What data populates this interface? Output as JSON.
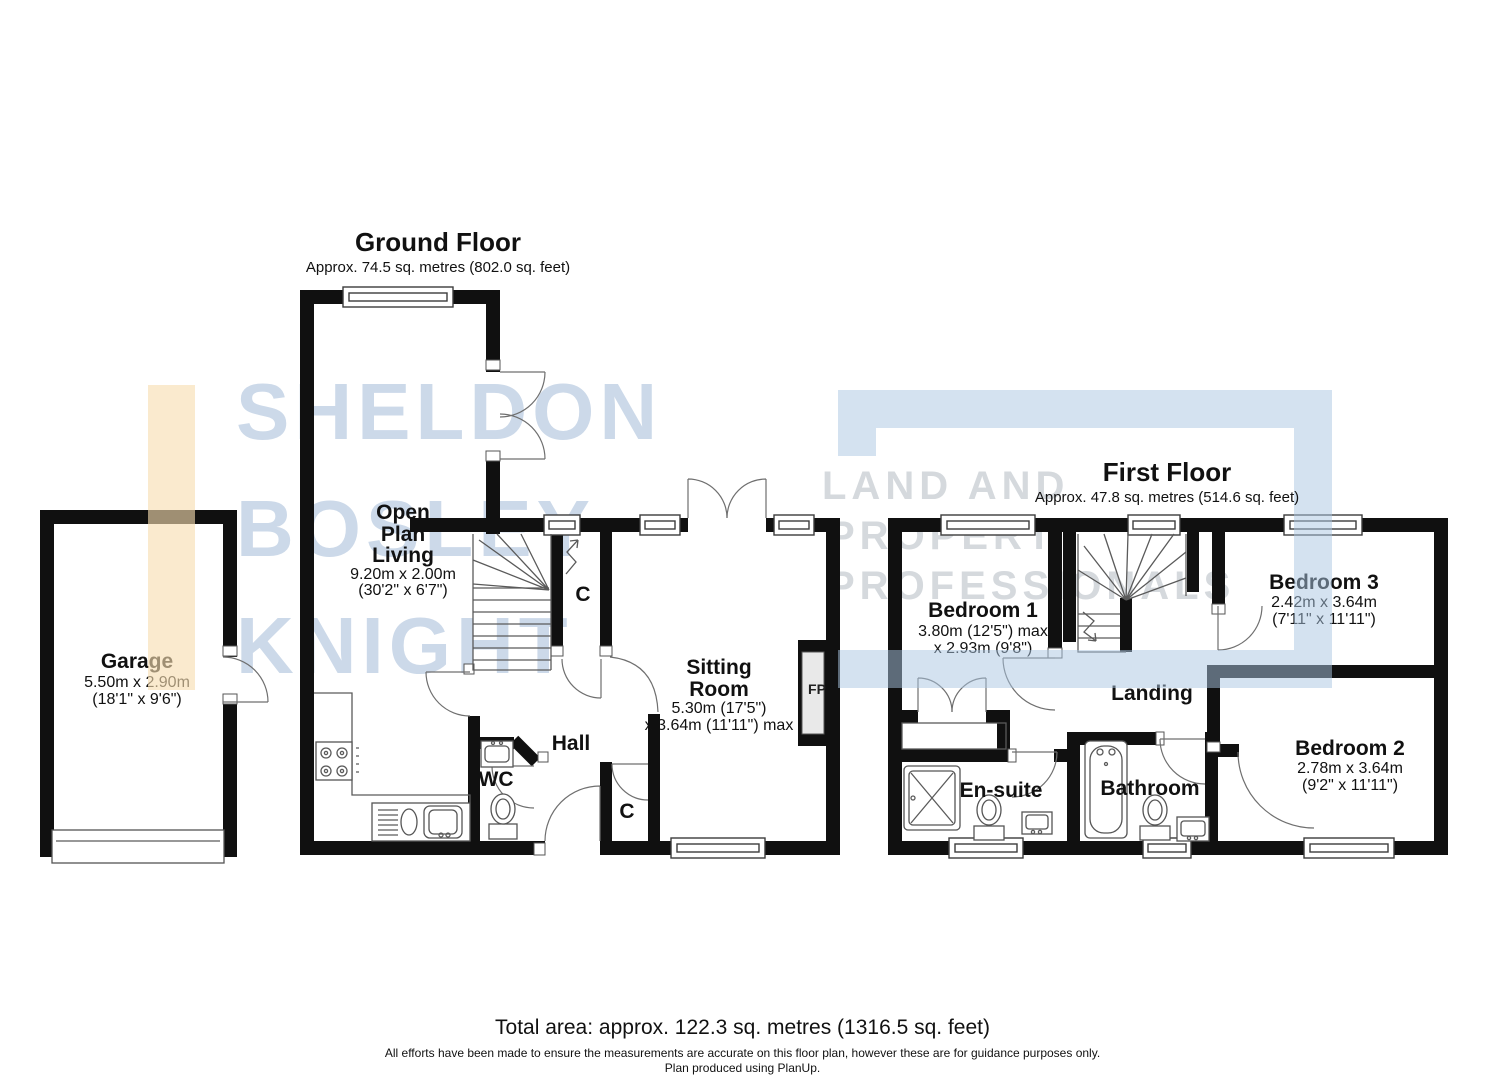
{
  "ground_floor": {
    "title": "Ground Floor",
    "subtitle": "Approx. 74.5 sq. metres (802.0 sq. feet)",
    "garage": {
      "name": "Garage",
      "dim1": "5.50m x 2.90m",
      "dim2": "(18'1\" x 9'6\")"
    },
    "open_plan_living": {
      "line1": "Open",
      "line2": "Plan",
      "line3": "Living",
      "dim1": "9.20m x 2.00m",
      "dim2": "(30'2\" x 6'7\")"
    },
    "sitting_room": {
      "line1": "Sitting",
      "line2": "Room",
      "dim1": "5.30m (17'5\")",
      "dim2": "x 3.64m (11'11\") max"
    },
    "hall": "Hall",
    "wc": "WC",
    "closet_top": "C",
    "closet_bottom": "C",
    "fireplace": "FP"
  },
  "first_floor": {
    "title": "First Floor",
    "subtitle": "Approx. 47.8 sq. metres (514.6 sq. feet)",
    "bedroom1": {
      "name": "Bedroom 1",
      "dim1": "3.80m (12'5\") max",
      "dim2": "x 2.93m (9'8\")"
    },
    "bedroom2": {
      "name": "Bedroom 2",
      "dim1": "2.78m x 3.64m",
      "dim2": "(9'2\" x 11'11\")"
    },
    "bedroom3": {
      "name": "Bedroom 3",
      "dim1": "2.42m x 3.64m",
      "dim2": "(7'11\" x 11'11\")"
    },
    "landing": "Landing",
    "bathroom": "Bathroom",
    "ensuite": "En-suite"
  },
  "footer": {
    "total_area": "Total area: approx. 122.3 sq. metres (1316.5 sq. feet)",
    "disclaimer1": "All efforts have been made to ensure the measurements are accurate on this floor plan, however these are for guidance purposes only.",
    "disclaimer2": "Plan produced using PlanUp."
  },
  "watermark": {
    "left_line1": "SHELDON",
    "left_line2": "BOSLEY",
    "left_line3": "KNIGHT",
    "right_line1": "LAND AND",
    "right_line2": "PROPERTY",
    "right_line3": "PROFESSIONALS",
    "colors": {
      "text_blue": "#ccd9e9",
      "text_gray": "#d5d9dd",
      "bar_orange": "#f7ddb0",
      "frame_blue": "#aac5e2",
      "wall_black": "#101010"
    }
  }
}
